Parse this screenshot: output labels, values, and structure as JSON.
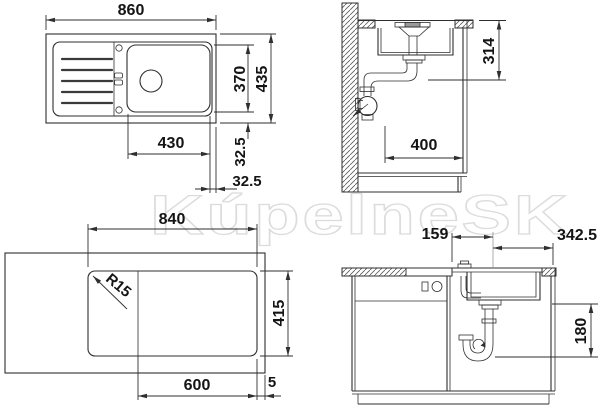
{
  "watermark": "KúpelneSK",
  "drawing": {
    "top_view": {
      "width": "860",
      "bowl_depth": "370",
      "total_depth": "435",
      "bowl_width": "430",
      "offset_bottom": "32.5",
      "offset_side": "32.5"
    },
    "side_view": {
      "drain_height": "314",
      "drain_offset": "400"
    },
    "cutout_view": {
      "width": "840",
      "corner_radius": "R15",
      "depth": "415",
      "bowl_section": "600",
      "edge_gap": "5"
    },
    "front_view": {
      "left_offset": "159",
      "right_offset": "342.5",
      "trap_drop": "180"
    }
  },
  "colors": {
    "line": "#2f2f2f",
    "dimension_text": "#141414",
    "watermark": "#dcdcdc",
    "background": "#ffffff"
  }
}
